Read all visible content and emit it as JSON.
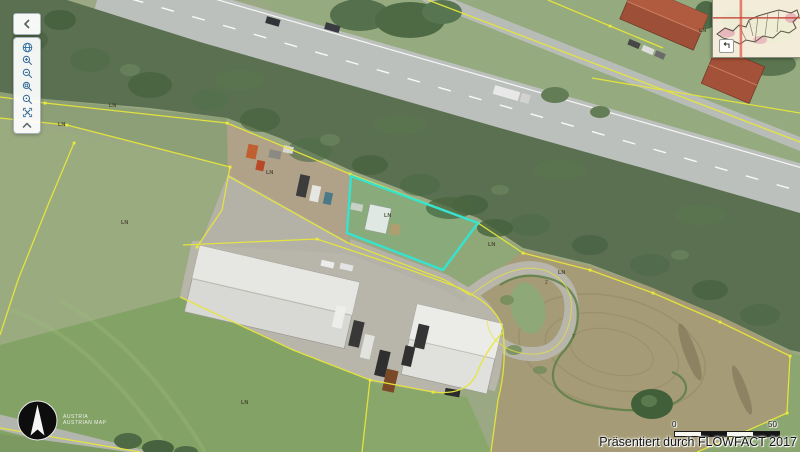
{
  "attribution": {
    "text": "Präsentiert durch FLOWFACT 2017"
  },
  "scale_bar": {
    "start_label": "0",
    "end_label": "50"
  },
  "logo": {
    "line1": "AUSTRIA",
    "line2": "AUSTRIAN MAP"
  },
  "toolbar": {
    "collapse_icon": "chevron-left-icon",
    "buttons": [
      {
        "id": "overview",
        "icon": "globe-icon"
      },
      {
        "id": "zoom-in",
        "icon": "magnifier-plus-icon"
      },
      {
        "id": "zoom-out",
        "icon": "magnifier-minus-icon"
      },
      {
        "id": "zoom-window",
        "icon": "magnifier-box-icon"
      },
      {
        "id": "zoom-extent",
        "icon": "magnifier-dot-icon"
      },
      {
        "id": "pan-fullscreen",
        "icon": "expand-arrows-icon"
      },
      {
        "id": "scroll-up",
        "icon": "chevron-up-icon"
      }
    ]
  },
  "overview_map": {
    "collapse_icon": "corner-arrow-icon",
    "crosshair_color": "#dd5a4e"
  },
  "map": {
    "selected_parcel_color": "#35e3cf",
    "boundary_color": "#e6e63c",
    "labels": [
      {
        "text": "LN"
      },
      {
        "text": "LN"
      },
      {
        "text": "LN"
      },
      {
        "text": "LN"
      },
      {
        "text": "LN"
      },
      {
        "text": "LN"
      },
      {
        "text": "LN"
      },
      {
        "text": "LN"
      },
      {
        "text": "LN"
      }
    ],
    "marks": [
      {
        "text": "2"
      },
      {
        "text": "7"
      }
    ]
  }
}
